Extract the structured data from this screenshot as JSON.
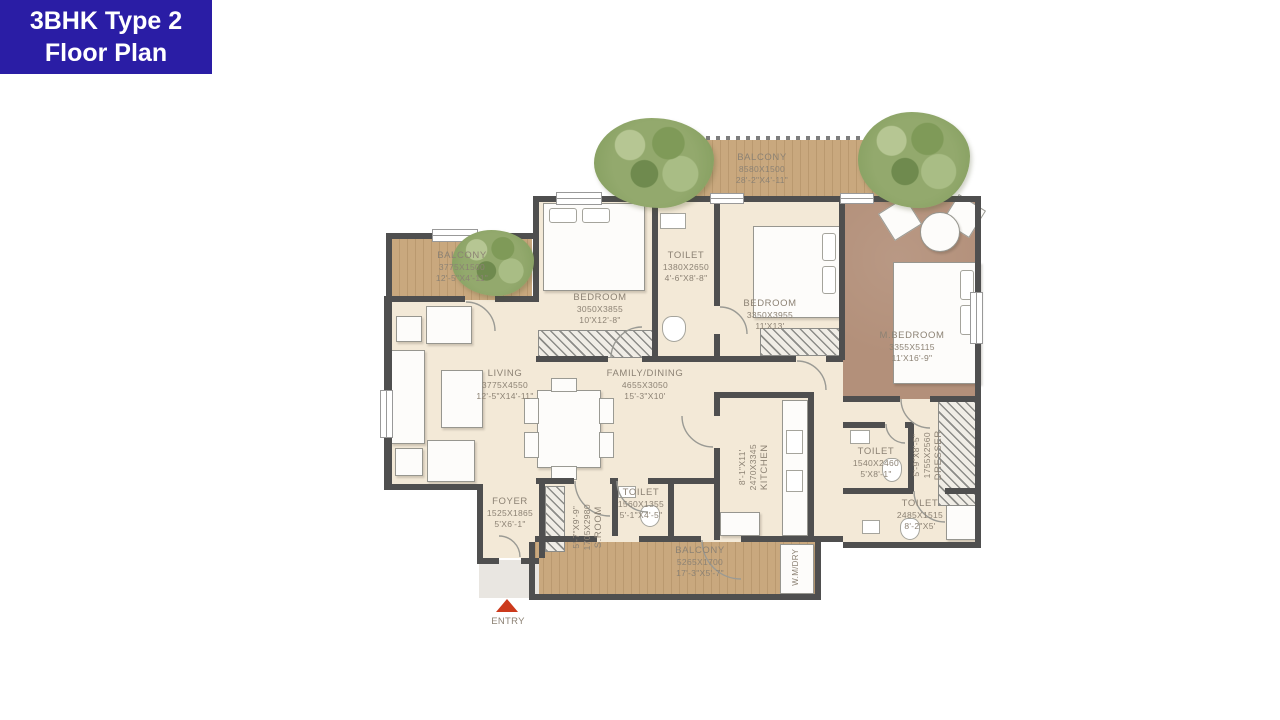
{
  "title": {
    "line1": "3BHK Type 2",
    "line2": "Floor Plan"
  },
  "colors": {
    "title_bg": "#2a1da5",
    "title_text": "#ffffff",
    "wall": "#4f4f4f",
    "floor_cream": "#f3e9d7",
    "floor_master": "#b3907a",
    "floor_wood": "#c9a87e",
    "label_text": "#8c8274",
    "entry_arrow": "#cc3a1c",
    "tree_green": "#93a96d"
  },
  "rooms": {
    "balcony_top": {
      "name": "BALCONY",
      "mm": "8580X1500",
      "ft": "28'-2\"X4'-11\""
    },
    "balcony_left": {
      "name": "BALCONY",
      "mm": "3775X1500",
      "ft": "12'-5\"X4'-11\""
    },
    "toilet_top": {
      "name": "TOILET",
      "mm": "1380X2650",
      "ft": "4'-6\"X8'-8\""
    },
    "bedroom1": {
      "name": "BEDROOM",
      "mm": "3050X3855",
      "ft": "10'X12'-8\""
    },
    "bedroom2": {
      "name": "BEDROOM",
      "mm": "3350X3955",
      "ft": "11'X13'"
    },
    "mbedroom": {
      "name": "M.BEDROOM",
      "mm": "3355X5115",
      "ft": "11'X16'-9\""
    },
    "living": {
      "name": "LIVING",
      "mm": "3775X4550",
      "ft": "12'-5\"X14'-11\""
    },
    "family_dining": {
      "name": "FAMILY/DINING",
      "mm": "4655X3050",
      "ft": "15'-3\"X10'"
    },
    "kitchen": {
      "name": "KITCHEN",
      "mm": "2470X3345",
      "ft": "8'-1\"X11'"
    },
    "toilet_mid": {
      "name": "TOILET",
      "mm": "1540X2460",
      "ft": "5'X8'-1\""
    },
    "dresser": {
      "name": "DRESSER",
      "mm": "1755X2560",
      "ft": "5'-9\"X8'-5\""
    },
    "toilet_right": {
      "name": "TOILET",
      "mm": "2485X1515",
      "ft": "8'-2\"X5'"
    },
    "foyer": {
      "name": "FOYER",
      "mm": "1525X1865",
      "ft": "5'X6'-1\""
    },
    "sroom": {
      "name": "S.ROOM",
      "mm": "1705X2980",
      "ft": "5'-7\"X9'-9\""
    },
    "toilet_small": {
      "name": "TOILET",
      "mm": "1560X1355",
      "ft": "5'-1\"X4'-5\""
    },
    "balcony_bottom": {
      "name": "BALCONY",
      "mm": "5265X1700",
      "ft": "17'-3\"X5'-7\""
    },
    "wm_dry": {
      "name": "W.M/DRY"
    },
    "entry": {
      "name": "ENTRY"
    }
  }
}
